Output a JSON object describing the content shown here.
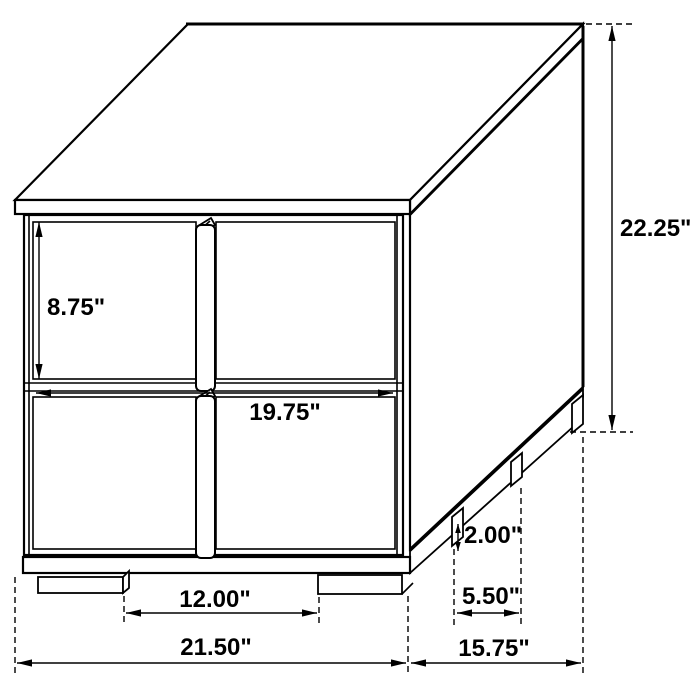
{
  "diagram": {
    "kind": "isometric-dimension-drawing",
    "colors": {
      "line": "#000000",
      "background": "#ffffff",
      "text": "#000000"
    },
    "dimensions": {
      "drawer_height": "8.75\"",
      "drawer_width": "19.75\"",
      "overall_height": "22.25\"",
      "front_leg_spacing": "12.00\"",
      "overall_width": "21.50\"",
      "overall_depth": "15.75\"",
      "side_leg_spacing": "5.50\"",
      "leg_height": "2.00\""
    }
  }
}
